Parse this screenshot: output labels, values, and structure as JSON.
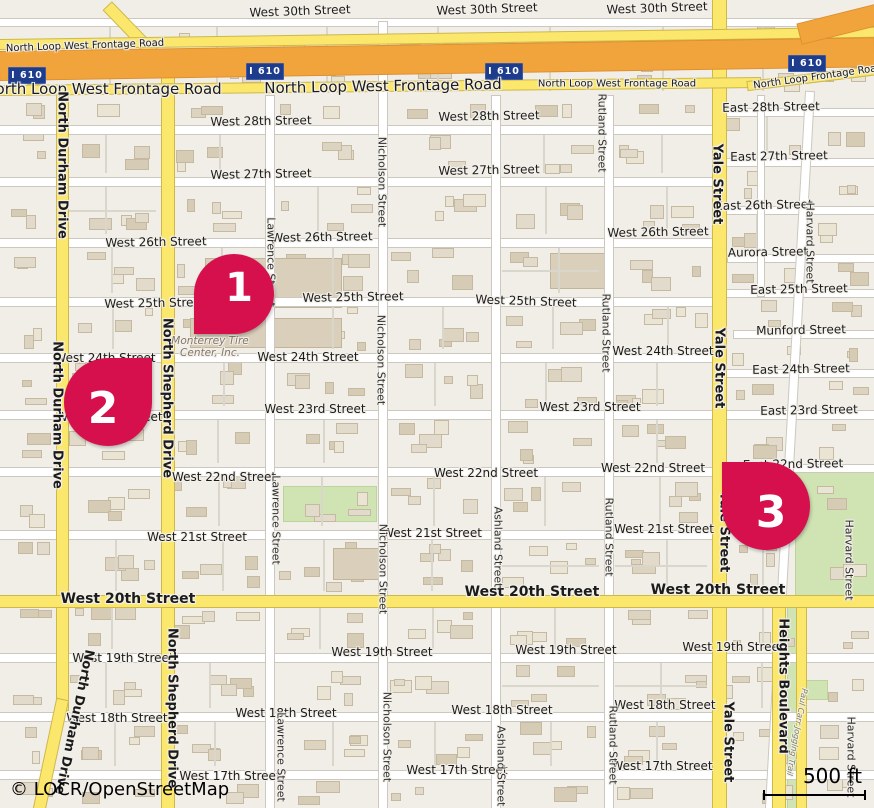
{
  "map": {
    "attribution": "© LOCR/OpenStreetMap",
    "scale_label": "500 ft",
    "shield_label": "I 610",
    "poi_tire_center": {
      "line1": "Monterrey Tire",
      "line2": "Center, Inc."
    }
  },
  "colors": {
    "marker": "#D5104D",
    "shield_bg": "#1E3C8C",
    "motorway": "#F2A43C",
    "road_yellow": "#FBE76C",
    "green": "#CFE3B3",
    "background": "#F1EEE8"
  },
  "markers": [
    {
      "number": "1",
      "x": 194,
      "y": 254,
      "size": 80,
      "tip": "bl"
    },
    {
      "number": "2",
      "x": 64,
      "y": 358,
      "size": 88,
      "tip": "tr"
    },
    {
      "number": "3",
      "x": 722,
      "y": 462,
      "size": 88,
      "tip": "tl"
    }
  ],
  "shields": [
    {
      "x": 8,
      "y": 67
    },
    {
      "x": 246,
      "y": 63
    },
    {
      "x": 485,
      "y": 63
    },
    {
      "x": 788,
      "y": 55
    }
  ],
  "greens": [
    {
      "x": 283,
      "y": 486,
      "w": 92,
      "h": 34
    },
    {
      "x": 795,
      "y": 470,
      "w": 79,
      "h": 128
    },
    {
      "x": 799,
      "y": 680,
      "w": 27,
      "h": 18
    },
    {
      "x": 787,
      "y": 602,
      "w": 8,
      "h": 206
    }
  ],
  "big_buildings": [
    {
      "x": 205,
      "y": 258,
      "w": 135,
      "h": 48
    },
    {
      "x": 190,
      "y": 318,
      "w": 150,
      "h": 28
    },
    {
      "x": 550,
      "y": 253,
      "w": 55,
      "h": 34
    },
    {
      "x": 333,
      "y": 548,
      "w": 46,
      "h": 30
    }
  ],
  "roads": [
    {
      "name": "West 30th Street",
      "o": "h",
      "x": 0,
      "y": 19,
      "len": 874,
      "w": 7,
      "c": "w"
    },
    {
      "name": "West 28th Street",
      "o": "h",
      "x": 0,
      "y": 126,
      "len": 720,
      "w": 8,
      "c": "w"
    },
    {
      "name": "West 27th Street",
      "o": "h",
      "x": 0,
      "y": 178,
      "len": 720,
      "w": 8,
      "c": "w"
    },
    {
      "name": "West 26th Street",
      "o": "h",
      "x": 0,
      "y": 239,
      "len": 720,
      "w": 8,
      "c": "w"
    },
    {
      "name": "West 25th Street",
      "o": "h",
      "x": 0,
      "y": 298,
      "len": 720,
      "w": 8,
      "c": "w"
    },
    {
      "name": "West 24th Street",
      "o": "h",
      "x": 0,
      "y": 354,
      "len": 720,
      "w": 8,
      "c": "w"
    },
    {
      "name": "West 23rd Street",
      "o": "h",
      "x": 0,
      "y": 411,
      "len": 874,
      "w": 8,
      "c": "w"
    },
    {
      "name": "West 22nd Street",
      "o": "h",
      "x": 0,
      "y": 468,
      "len": 720,
      "w": 8,
      "c": "w"
    },
    {
      "name": "West 21st Street",
      "o": "h",
      "x": 0,
      "y": 531,
      "len": 720,
      "w": 8,
      "c": "w"
    },
    {
      "name": "West 19th Street",
      "o": "h",
      "x": 0,
      "y": 654,
      "len": 874,
      "w": 8,
      "c": "w"
    },
    {
      "name": "West 18th Street",
      "o": "h",
      "x": 0,
      "y": 713,
      "len": 874,
      "w": 8,
      "c": "w"
    },
    {
      "name": "West 17th Street",
      "o": "h",
      "x": 0,
      "y": 771,
      "len": 874,
      "w": 8,
      "c": "w"
    },
    {
      "name": "East 28th Street",
      "o": "h",
      "x": 722,
      "y": 109,
      "len": 152,
      "w": 7,
      "c": "w"
    },
    {
      "name": "East 27th Street",
      "o": "h",
      "x": 722,
      "y": 159,
      "len": 152,
      "w": 7,
      "c": "w"
    },
    {
      "name": "East 26th Street",
      "o": "h",
      "x": 722,
      "y": 207,
      "len": 152,
      "w": 7,
      "c": "w"
    },
    {
      "name": "Aurora Street",
      "o": "h",
      "x": 728,
      "y": 255,
      "len": 146,
      "w": 7,
      "c": "w"
    },
    {
      "name": "East 25th Street",
      "o": "h",
      "x": 722,
      "y": 290,
      "len": 152,
      "w": 7,
      "c": "w"
    },
    {
      "name": "Munford Street",
      "o": "h",
      "x": 734,
      "y": 331,
      "len": 140,
      "w": 7,
      "c": "w"
    },
    {
      "name": "East 24th Street",
      "o": "h",
      "x": 722,
      "y": 370,
      "len": 152,
      "w": 7,
      "c": "w"
    },
    {
      "name": "East 22nd Street",
      "o": "h",
      "x": 722,
      "y": 465,
      "len": 152,
      "w": 7,
      "c": "w"
    },
    {
      "name": "Lawrence Street",
      "o": "v",
      "x": 266,
      "y": 96,
      "len": 712,
      "w": 8,
      "c": "w"
    },
    {
      "name": "Nicholson Street",
      "o": "v",
      "x": 379,
      "y": 22,
      "len": 786,
      "w": 8,
      "c": "w"
    },
    {
      "name": "Ashland Street",
      "o": "v",
      "x": 492,
      "y": 96,
      "len": 712,
      "w": 8,
      "c": "w"
    },
    {
      "name": "Rutland Street",
      "o": "v",
      "x": 605,
      "y": 96,
      "len": 712,
      "w": 8,
      "c": "w"
    },
    {
      "name": "Harvard Street",
      "o": "v",
      "x": 806,
      "y": 92,
      "len": 720,
      "w": 8,
      "c": "w",
      "r": 3.2,
      "org": "top center"
    },
    {
      "name": "unnamed",
      "o": "v",
      "x": 758,
      "y": 96,
      "len": 200,
      "w": 6,
      "c": "w"
    },
    {
      "name": "North Durham Drive",
      "o": "v",
      "x": 57,
      "y": 90,
      "len": 620,
      "w": 11,
      "c": "y"
    },
    {
      "name": "North Durham Drive",
      "o": "v",
      "x": 57,
      "y": 700,
      "len": 115,
      "w": 11,
      "c": "y",
      "r": 12,
      "org": "top center"
    },
    {
      "name": "North Shepherd Drive",
      "o": "v",
      "x": 162,
      "y": 52,
      "len": 756,
      "w": 12,
      "c": "y"
    },
    {
      "name": "North Shepherd Drive",
      "o": "v",
      "x": 158,
      "y": -16,
      "len": 80,
      "w": 11,
      "c": "y",
      "r": -44,
      "org": "bottom center"
    },
    {
      "name": "Yale Street",
      "o": "v",
      "x": 713,
      "y": 0,
      "len": 808,
      "w": 13,
      "c": "y"
    },
    {
      "name": "Heights Boulevard",
      "o": "v",
      "x": 773,
      "y": 602,
      "len": 206,
      "w": 12,
      "c": "y"
    },
    {
      "name": "Heights Boulevard",
      "o": "v",
      "x": 797,
      "y": 602,
      "len": 206,
      "w": 9,
      "c": "y"
    },
    {
      "name": "West 20th Street",
      "o": "h",
      "x": 0,
      "y": 596,
      "len": 874,
      "w": 11,
      "c": "y"
    },
    {
      "name": "North Loop West Frontage Road",
      "o": "h",
      "x": 0,
      "y": 40,
      "len": 874,
      "w": 9,
      "c": "y",
      "r": -0.8,
      "org": "left center"
    },
    {
      "name": "North Loop West Frontage Road",
      "o": "h",
      "x": 0,
      "y": 86,
      "len": 760,
      "w": 9,
      "c": "y",
      "r": -0.6,
      "org": "left center"
    },
    {
      "name": "North Loop Frontage Road",
      "o": "h",
      "x": 748,
      "y": 82,
      "len": 132,
      "w": 8,
      "c": "y",
      "r": -7,
      "org": "left center"
    },
    {
      "name": "I 610",
      "o": "h",
      "x": 0,
      "y": 52,
      "len": 874,
      "w": 28,
      "c": "o",
      "r": -0.9,
      "org": "left center"
    },
    {
      "name": "I 610",
      "o": "h",
      "x": 800,
      "y": 24,
      "len": 100,
      "w": 20,
      "c": "o",
      "r": -14,
      "org": "left center"
    }
  ],
  "labels": [
    {
      "t": "West 30th Street",
      "x": 300,
      "y": 11,
      "r": -2
    },
    {
      "t": "West 30th Street",
      "x": 487,
      "y": 9,
      "r": -2
    },
    {
      "t": "West 30th Street",
      "x": 657,
      "y": 8,
      "r": -2
    },
    {
      "t": "North Loop West Frontage Road",
      "x": 85,
      "y": 46,
      "s": 10,
      "r": -2
    },
    {
      "t": "North Loop West Frontage Road",
      "x": 103,
      "y": 89,
      "s": 15
    },
    {
      "t": "North Loop West Frontage Road",
      "x": 383,
      "y": 86,
      "s": 15,
      "r": -1
    },
    {
      "t": "North Loop West Frontage Road",
      "x": 617,
      "y": 84,
      "s": 10
    },
    {
      "t": "North Loop Frontage Road",
      "x": 818,
      "y": 77,
      "s": 10,
      "r": -8
    },
    {
      "t": "West 28th Street",
      "x": 261,
      "y": 121,
      "r": -1
    },
    {
      "t": "West 28th Street",
      "x": 489,
      "y": 116,
      "r": -1
    },
    {
      "t": "East 28th Street",
      "x": 771,
      "y": 107,
      "r": -1
    },
    {
      "t": "West 27th Street",
      "x": 261,
      "y": 174,
      "r": -1
    },
    {
      "t": "West 27th Street",
      "x": 489,
      "y": 170,
      "r": -1
    },
    {
      "t": "East 27th Street",
      "x": 779,
      "y": 156,
      "r": -1
    },
    {
      "t": "West 26th Street",
      "x": 156,
      "y": 242,
      "r": -1
    },
    {
      "t": "West 26th Street",
      "x": 322,
      "y": 237,
      "r": -1
    },
    {
      "t": "West 26th Street",
      "x": 658,
      "y": 232,
      "r": -1
    },
    {
      "t": "East 26th Street",
      "x": 764,
      "y": 205,
      "r": -1
    },
    {
      "t": "Aurora Street",
      "x": 768,
      "y": 252,
      "r": -1
    },
    {
      "t": "West 25th Street",
      "x": 155,
      "y": 303,
      "r": -1
    },
    {
      "t": "West 25th Street",
      "x": 353,
      "y": 297,
      "r": -1
    },
    {
      "t": "West 25th Street",
      "x": 526,
      "y": 301,
      "r": 2
    },
    {
      "t": "East 25th Street",
      "x": 799,
      "y": 289,
      "r": -1
    },
    {
      "t": "Munford Street",
      "x": 801,
      "y": 330,
      "r": -1
    },
    {
      "t": "West 24th Street",
      "x": 105,
      "y": 358
    },
    {
      "t": "West 24th Street",
      "x": 308,
      "y": 357
    },
    {
      "t": "West 24th Street",
      "x": 663,
      "y": 351
    },
    {
      "t": "East 24th Street",
      "x": 801,
      "y": 369,
      "r": -1
    },
    {
      "t": "West 23rd Street",
      "x": 112,
      "y": 417
    },
    {
      "t": "West 23rd Street",
      "x": 315,
      "y": 409
    },
    {
      "t": "West 23rd Street",
      "x": 590,
      "y": 407
    },
    {
      "t": "East 23rd Street",
      "x": 809,
      "y": 410,
      "r": -1
    },
    {
      "t": "West 22nd Street",
      "x": 224,
      "y": 477
    },
    {
      "t": "West 22nd Street",
      "x": 486,
      "y": 473
    },
    {
      "t": "West 22nd Street",
      "x": 653,
      "y": 468
    },
    {
      "t": "East 22nd Street",
      "x": 793,
      "y": 464,
      "r": -1
    },
    {
      "t": "West 21st Street",
      "x": 197,
      "y": 537
    },
    {
      "t": "West 21st Street",
      "x": 432,
      "y": 533
    },
    {
      "t": "West 21st Street",
      "x": 664,
      "y": 529
    },
    {
      "t": "West 20th Street",
      "x": 128,
      "y": 599,
      "s": 14,
      "b": true
    },
    {
      "t": "West 20th Street",
      "x": 532,
      "y": 592,
      "s": 14,
      "b": true
    },
    {
      "t": "West 20th Street",
      "x": 718,
      "y": 590,
      "s": 14,
      "b": true
    },
    {
      "t": "West 19th Street",
      "x": 123,
      "y": 658
    },
    {
      "t": "West 19th Street",
      "x": 382,
      "y": 652
    },
    {
      "t": "West 19th Street",
      "x": 566,
      "y": 650
    },
    {
      "t": "West 19th Street",
      "x": 733,
      "y": 647
    },
    {
      "t": "West 18th Street",
      "x": 117,
      "y": 718
    },
    {
      "t": "West 18th Street",
      "x": 286,
      "y": 713
    },
    {
      "t": "West 18th Street",
      "x": 502,
      "y": 710
    },
    {
      "t": "West 18th Street",
      "x": 665,
      "y": 705
    },
    {
      "t": "West 17th Street",
      "x": 230,
      "y": 776
    },
    {
      "t": "West 17th Street",
      "x": 457,
      "y": 770
    },
    {
      "t": "West 17th Street",
      "x": 662,
      "y": 766
    },
    {
      "t": "North Durham Drive",
      "x": 62,
      "y": 165,
      "r": 90,
      "s": 13,
      "b": true
    },
    {
      "t": "North Durham Drive",
      "x": 57,
      "y": 415,
      "r": 90,
      "s": 13,
      "b": true
    },
    {
      "t": "North Durham Drive",
      "x": 74,
      "y": 722,
      "r": 102,
      "s": 13,
      "b": true
    },
    {
      "t": "North Shepherd Drive",
      "x": 167,
      "y": 398,
      "r": 90,
      "s": 13,
      "b": true
    },
    {
      "t": "North Shepherd Drive",
      "x": 172,
      "y": 708,
      "r": 90,
      "s": 13,
      "b": true
    },
    {
      "t": "Yale Street",
      "x": 717,
      "y": 184,
      "r": 90,
      "s": 13,
      "b": true
    },
    {
      "t": "Yale Street",
      "x": 719,
      "y": 368,
      "r": 90,
      "s": 13,
      "b": true
    },
    {
      "t": "Yale Street",
      "x": 724,
      "y": 532,
      "r": 90,
      "s": 13,
      "b": true
    },
    {
      "t": "Yale Street",
      "x": 728,
      "y": 742,
      "r": 90,
      "s": 13,
      "b": true
    },
    {
      "t": "Heights Boulevard",
      "x": 783,
      "y": 686,
      "r": 90,
      "s": 13,
      "b": true
    },
    {
      "t": "Lawrence Street",
      "x": 271,
      "y": 262,
      "r": 90,
      "s": 11,
      "c": "#2e2e2e"
    },
    {
      "t": "Lawrence Street",
      "x": 276,
      "y": 520,
      "r": 90,
      "s": 11,
      "c": "#2e2e2e"
    },
    {
      "t": "Lawrence Street",
      "x": 281,
      "y": 757,
      "r": 90,
      "s": 11,
      "c": "#2e2e2e"
    },
    {
      "t": "Nicholson Street",
      "x": 382,
      "y": 182,
      "r": 90,
      "s": 11,
      "c": "#2e2e2e"
    },
    {
      "t": "Nicholson Street",
      "x": 381,
      "y": 360,
      "r": 90,
      "s": 11,
      "c": "#2e2e2e"
    },
    {
      "t": "Nicholson Street",
      "x": 383,
      "y": 569,
      "r": 90,
      "s": 11,
      "c": "#2e2e2e"
    },
    {
      "t": "Nicholson Street",
      "x": 387,
      "y": 737,
      "r": 90,
      "s": 11,
      "c": "#2e2e2e"
    },
    {
      "t": "Ashland Street",
      "x": 498,
      "y": 547,
      "r": 90,
      "s": 11,
      "c": "#2e2e2e"
    },
    {
      "t": "Ashland Street",
      "x": 501,
      "y": 766,
      "r": 90,
      "s": 11,
      "c": "#2e2e2e"
    },
    {
      "t": "Rutland Street",
      "x": 602,
      "y": 133,
      "r": 90,
      "s": 11,
      "c": "#2e2e2e"
    },
    {
      "t": "Rutland Street",
      "x": 606,
      "y": 333,
      "r": 90,
      "s": 11,
      "c": "#2e2e2e"
    },
    {
      "t": "Rutland Street",
      "x": 609,
      "y": 537,
      "r": 90,
      "s": 11,
      "c": "#2e2e2e"
    },
    {
      "t": "Rutland Street",
      "x": 613,
      "y": 745,
      "r": 90,
      "s": 11,
      "c": "#2e2e2e"
    },
    {
      "t": "Harvard Street",
      "x": 810,
      "y": 243,
      "r": 90,
      "s": 11,
      "c": "#2e2e2e"
    },
    {
      "t": "Harvard Street",
      "x": 849,
      "y": 560,
      "r": 90,
      "s": 11,
      "c": "#2e2e2e"
    },
    {
      "t": "Harvard Street",
      "x": 851,
      "y": 757,
      "r": 90,
      "s": 11,
      "c": "#2e2e2e"
    },
    {
      "t": "Paul Carr Jogging Trail",
      "x": 797,
      "y": 732,
      "r": 100,
      "s": 8,
      "c": "#7C8066",
      "i": true
    }
  ]
}
